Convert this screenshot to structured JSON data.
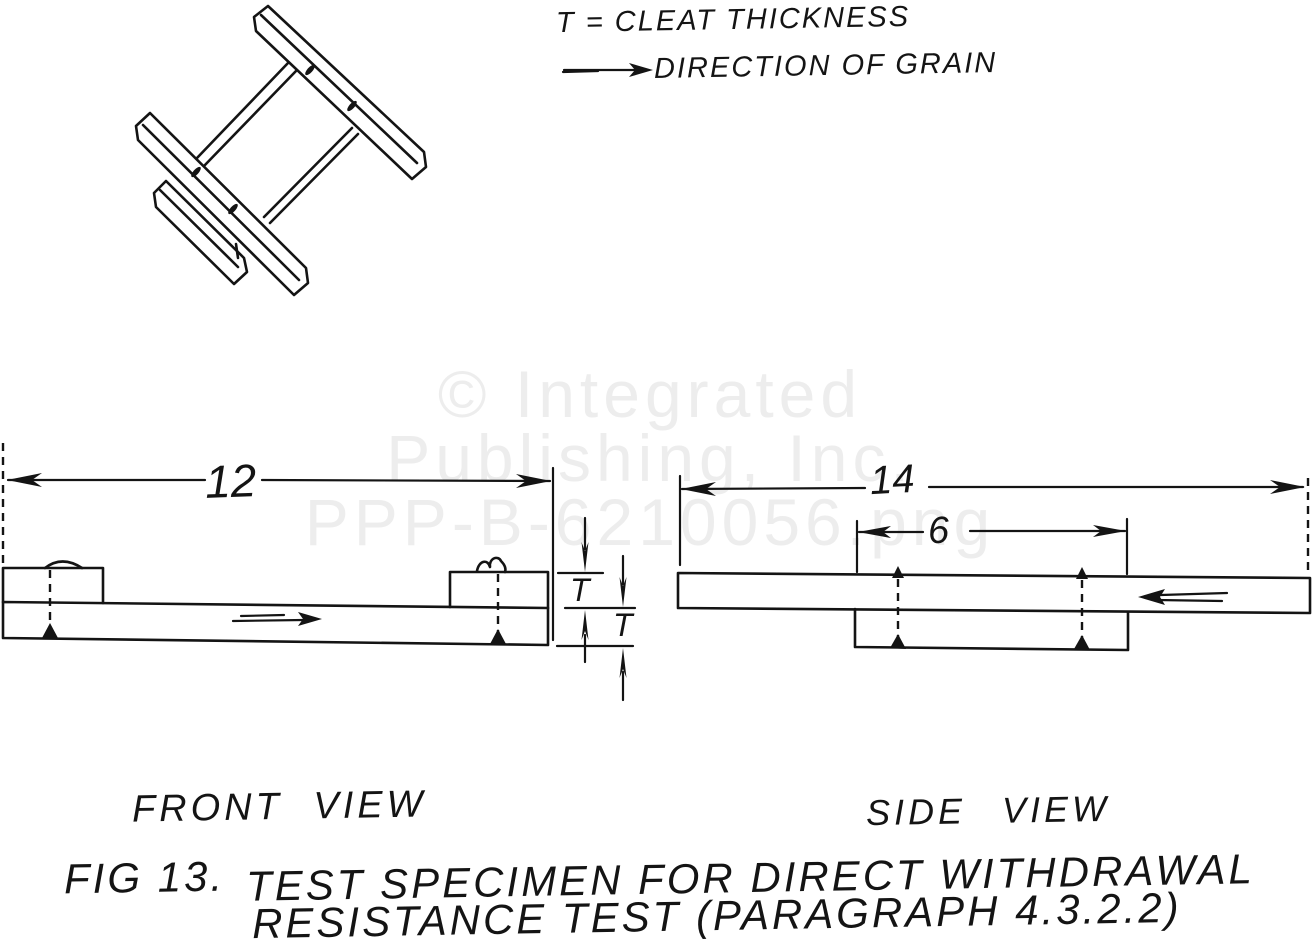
{
  "colors": {
    "ink": "#141414",
    "background": "#ffffff",
    "watermark": "#ededed"
  },
  "legend": {
    "cleat_thickness": "T = CLEAT THICKNESS",
    "grain_direction": "DIRECTION OF GRAIN"
  },
  "watermark": {
    "line1": "© Integrated",
    "line2": "Publishing, Inc.",
    "line3": "PPP-B-6210056.png"
  },
  "front_view": {
    "label": "FRONT VIEW",
    "width_dim": "12",
    "cleat_thickness_dim": "T",
    "board_thickness_dim": "T"
  },
  "side_view": {
    "label": "SIDE VIEW",
    "width_dim": "14",
    "cleat_spacing_dim": "6"
  },
  "caption": {
    "fig_label": "FIG 13.",
    "line1": "TEST SPECIMEN FOR DIRECT WITHDRAWAL",
    "line2": "RESISTANCE TEST (PARAGRAPH 4.3.2.2)"
  }
}
